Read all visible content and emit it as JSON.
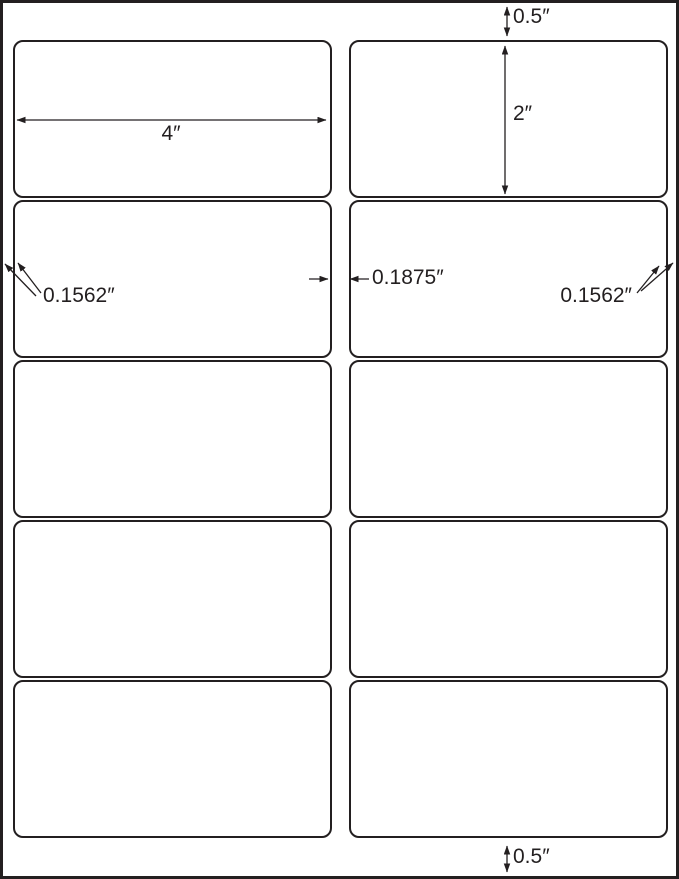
{
  "colors": {
    "line": "#231f20",
    "background": "#ffffff"
  },
  "sheet": {
    "columns": 2,
    "rows": 5,
    "label_count": 10
  },
  "annotations": {
    "top_margin": "0.5″",
    "label_height": "2″",
    "label_width": "4″",
    "left_margin": "0.1562″",
    "column_gap": "0.1875″",
    "right_margin": "0.1562″",
    "bottom_margin": "0.5″"
  }
}
